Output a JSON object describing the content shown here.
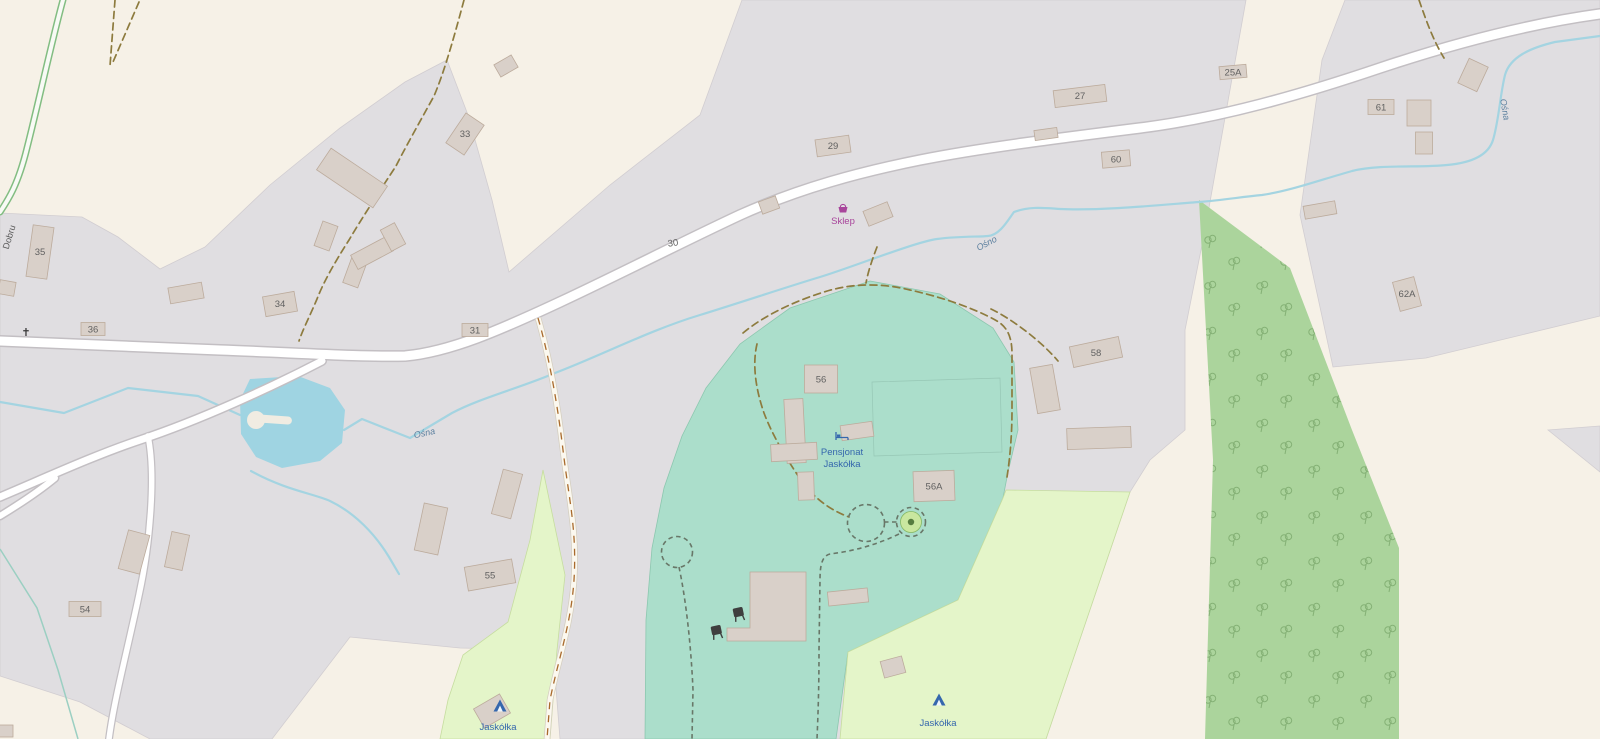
{
  "map": {
    "street_label": "Dobru",
    "stream_labels": {
      "left": "Ośna",
      "center": "Ośno",
      "right": "Ośna"
    },
    "pois": {
      "shop": {
        "label": "Sklep"
      },
      "pension": {
        "line1": "Pensjonat",
        "line2": "Jaskółka"
      },
      "campsite_west": {
        "label": "Jaskółka"
      },
      "campsite_east": {
        "label": "Jaskółka"
      }
    },
    "house_numbers": {
      "h25A": "25A",
      "h27": "27",
      "h29": "29",
      "h30": "30",
      "h31": "31",
      "h33": "33",
      "h34": "34",
      "h35": "35",
      "h36": "36",
      "h54": "54",
      "h55": "55",
      "h56": "56",
      "h56A": "56A",
      "h58": "58",
      "h60": "60",
      "h61": "61",
      "h62A": "62A"
    }
  },
  "colors": {
    "farmland": "#f6f1e7",
    "residential": "#e0dee1",
    "residential_line": "#d1cdd1",
    "resort": "#abdecb",
    "resort_line": "#8cc7af",
    "meadow": "#e4f5c9",
    "meadow_line": "#c6dd9f",
    "forest": "#abd49c",
    "tree": "#7aa86b",
    "water": "#9fd4e2",
    "water_line": "#a4d4e1",
    "ditch": "#9bcfc2",
    "road_fill": "#ffffff",
    "road_casing": "#c3bfc3",
    "track_fill": "#fbf8ef",
    "track_casing": "#d4cebf",
    "track_dash": "#a96a2c",
    "green_road": "#82bd82",
    "building": "#d9d0c9",
    "building_line": "#bcab9c",
    "path_olive": "#8d7b3e",
    "path_green": "#687768",
    "poi_blue": "#3567ad",
    "shop_magenta": "#a8459b",
    "house_number": "#616161",
    "cross": "#3a3a3a",
    "island": "#f0ece2",
    "circle_green": "#c9e79f",
    "circle_dot": "#567d3f",
    "bbq": "#3f3f3f"
  }
}
